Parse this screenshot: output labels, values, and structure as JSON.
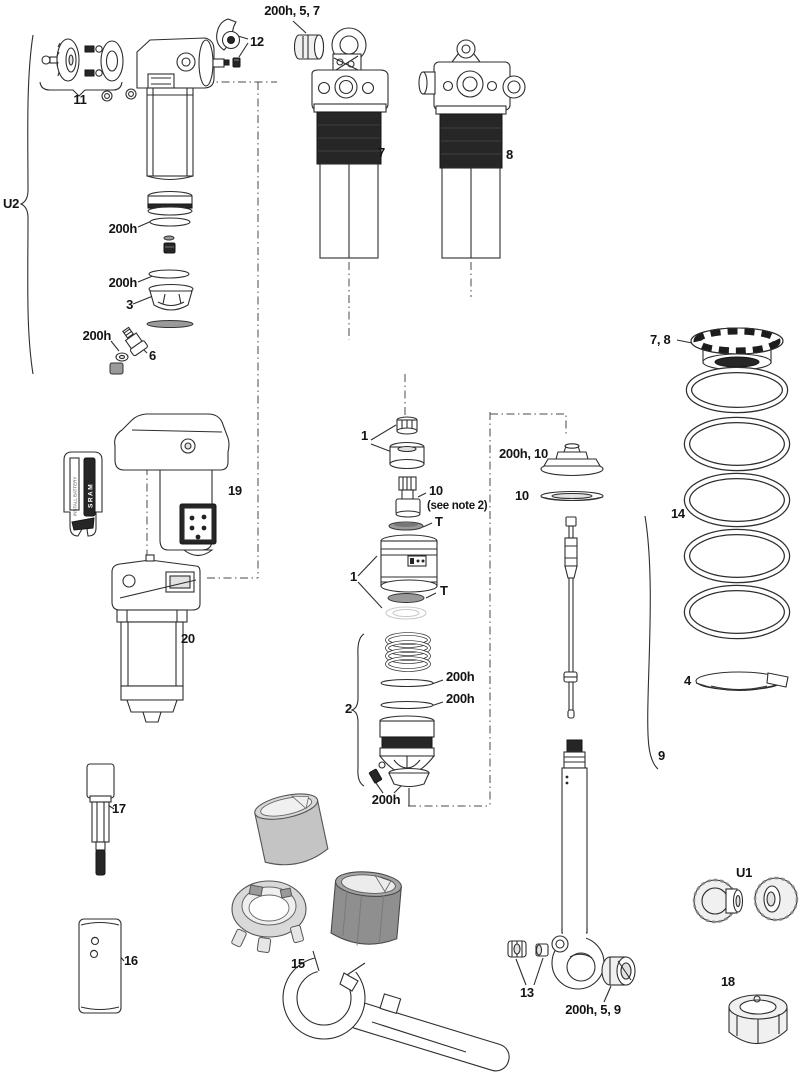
{
  "callouts": {
    "top_bushing": "200h, 5, 7",
    "lever": "12",
    "knob_kit": "11",
    "u2_assembly": "U2",
    "shock_left": "7",
    "shock_right": "8",
    "seal_a": "200h",
    "seal_b": "200h",
    "piston": "3",
    "seal_c": "200h",
    "valve": "6",
    "preload_collar": "7, 8",
    "coil_spring": "14",
    "shaft_hw_top": "1",
    "neg_valve": "10",
    "neg_valve_note": "(see note 2)",
    "t_seal_upper": "T",
    "body_asm": "1",
    "t_seal_lower": "T",
    "topout": "200h, 10",
    "topout_shim": "10",
    "rebound_asm": "2",
    "oring_a": "200h",
    "oring_b": "200h",
    "oring_c": "200h",
    "damper_shaft": "9",
    "spring_seat": "4",
    "remote": "19",
    "motor_module": "20",
    "tool_rod": "17",
    "tool_block": "16",
    "tool_kit": "15",
    "mount_hw": "13",
    "eyelet_bushing": "200h, 5, 9",
    "u1_hardware": "U1",
    "mount_bushing": "18"
  },
  "battery_label": {
    "caution": "INSTALL BATTERY",
    "brand": "SRAM"
  },
  "colors": {
    "ink": "#2e2e2e",
    "solid_black": "#262626",
    "tool_gray_light": "#c4c4c4",
    "tool_gray_dark": "#8f8f8f"
  }
}
